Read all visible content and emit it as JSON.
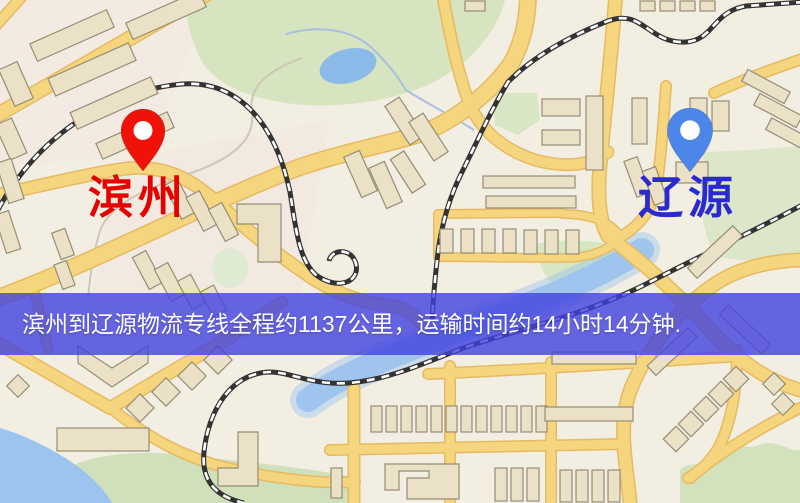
{
  "banner": {
    "text": "滨州到辽源物流专线全程约1137公里，运输时间约14小时14分钟.",
    "bg_color": "rgba(65,65,224,0.8)",
    "text_color": "#ffffff"
  },
  "markers": {
    "origin": {
      "label": "滨州",
      "label_color": "#e60000",
      "pin_color": "#f01209"
    },
    "destination": {
      "label": "辽源",
      "label_color": "#2b29d2",
      "pin_color": "#4c86e9"
    }
  },
  "theme": {
    "map_bg": "#f2eee2",
    "road_fill": "#f5d57d",
    "road_casing": "#e6ba62",
    "building_fill": "#eae1c7",
    "building_stroke": "#978d76",
    "park_fill": "#d6e4c0",
    "park_fill_alt": "#dbe7c8",
    "water_fill": "#9cc4ee",
    "pond_fill": "#8cbae8",
    "railway_dark": "#333333",
    "railway_light": "#ffffff",
    "origin_label": "#e60000",
    "dest_label": "#2b29d2",
    "origin_pin": "#f01209",
    "dest_pin": "#4c86e9",
    "banner_bg": "rgba(65,65,224,0.8)",
    "banner_text": "#ffffff"
  }
}
